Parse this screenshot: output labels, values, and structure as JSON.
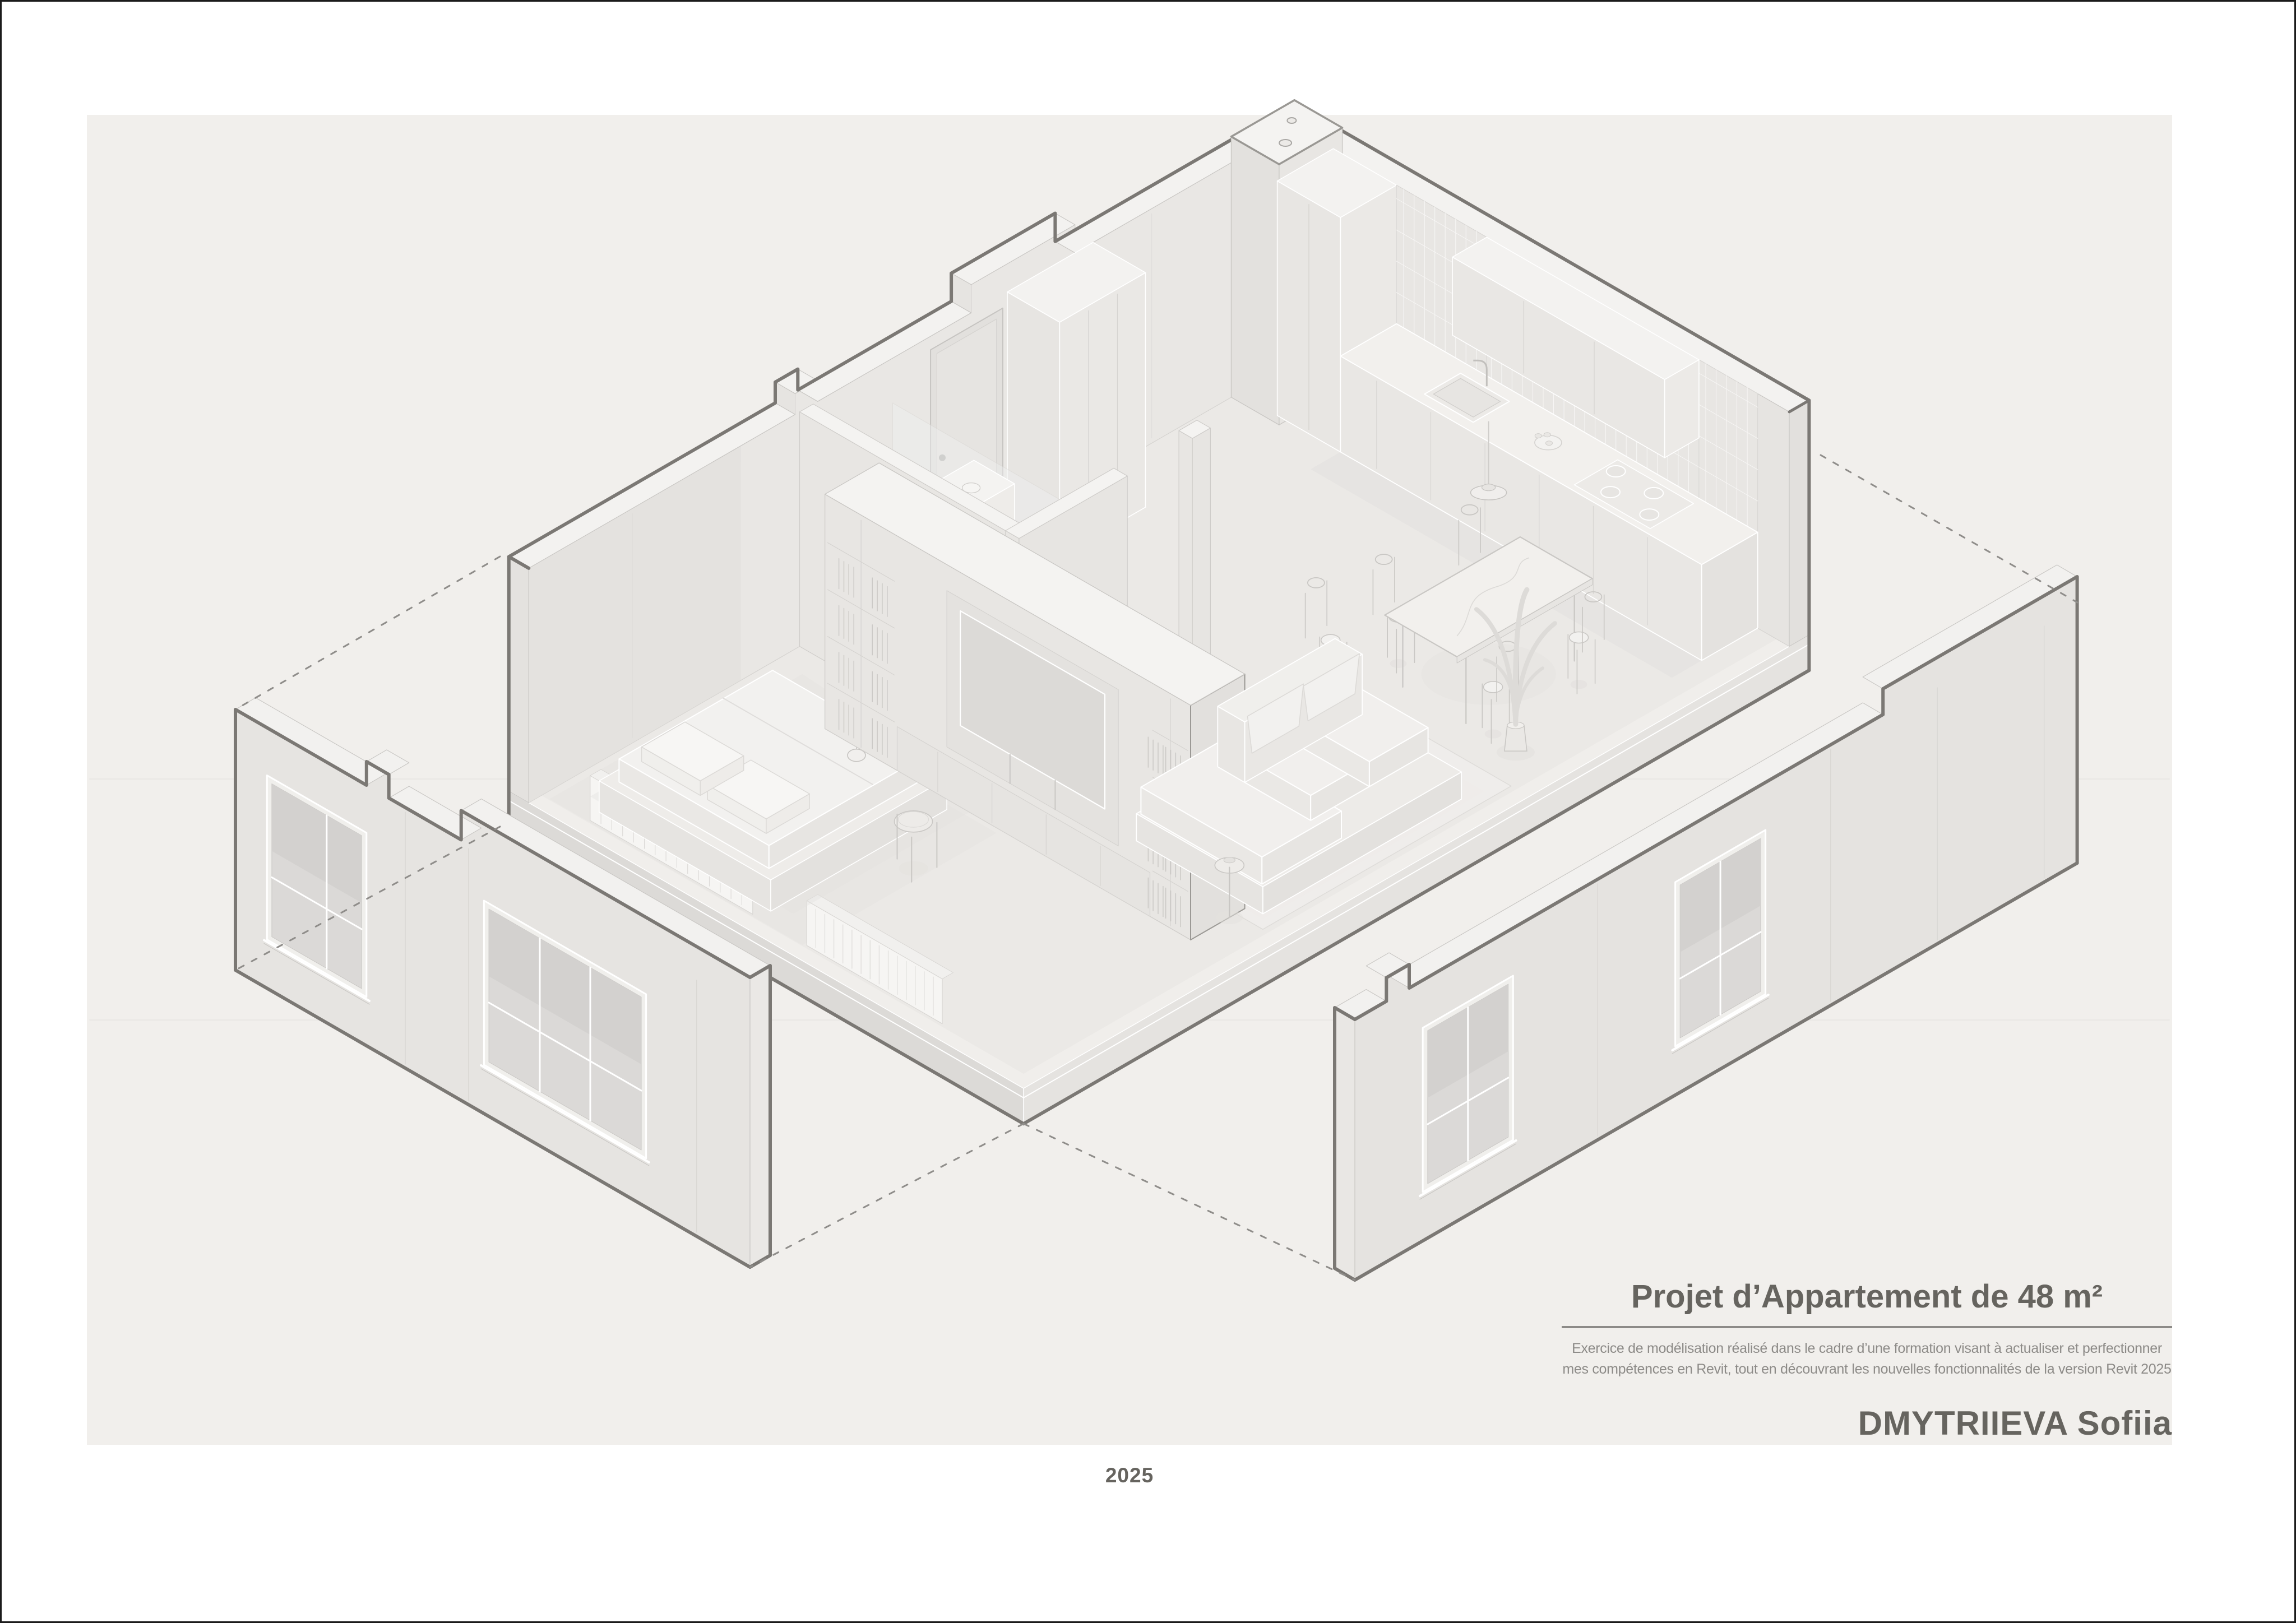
{
  "title_block": {
    "title": "Projet d’Appartement de 48 m²",
    "subtitle_line1": "Exercice de modélisation réalisé dans le cadre d’une formation visant à actualiser et perfectionner",
    "subtitle_line2": "mes compétences en Revit, tout en découvrant les nouvelles fonctionnalités de la version Revit 2025",
    "author": "DMYTRIIEVA Sofiia"
  },
  "footer": {
    "year": "2025"
  },
  "drawing": {
    "type": "axonometric-cutaway",
    "subject": "48 m² apartment model with exploded facade walls",
    "elements": [
      "floor-slab",
      "cut-perimeter-walls",
      "entry-door",
      "technical-shaft",
      "kitchen-counter",
      "kitchen-upper-cabinets",
      "tiled-backsplash",
      "cooktop",
      "sink",
      "entry-closet",
      "bathroom",
      "bed",
      "pillows",
      "pendant-lamp",
      "bedside-table",
      "radiators",
      "tv-shelving-wall",
      "tv",
      "dining-table",
      "dining-chairs",
      "sofa",
      "rug",
      "potted-plant",
      "facade-panel-left",
      "facade-panel-right",
      "explosion-dotted-lines"
    ]
  },
  "palette": {
    "page_bg": "#ffffff",
    "board_bg": "#f1efec",
    "face_light": "#eceae7",
    "face_mid": "#e7e5e2",
    "face_dark": "#dfddda",
    "top_face": "#f3f2f0",
    "line_light": "#ffffff",
    "line_soft": "#d5d3d0",
    "outline_heavy": "#7b7874",
    "dotted": "#8f8d8a",
    "text_dark": "#66645f",
    "text_soft": "#8d8b88"
  }
}
